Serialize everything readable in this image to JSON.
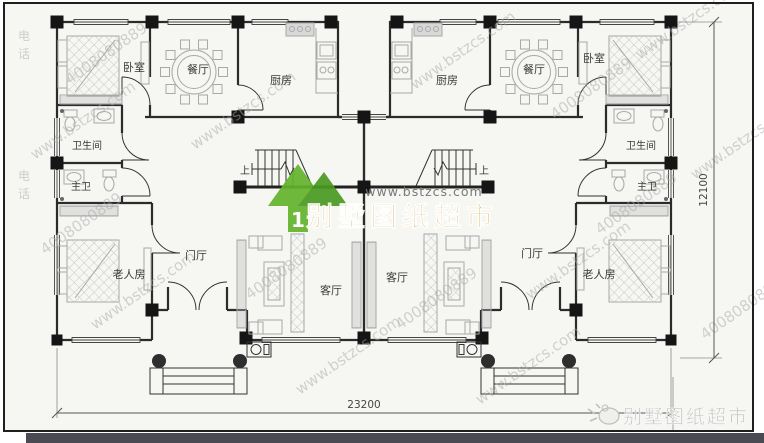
{
  "plan": {
    "rooms": {
      "bedroom": "卧室",
      "dining": "餐厅",
      "kitchen": "厨房",
      "bathroom": "卫生间",
      "master_bath": "主卫",
      "elder_room": "老人房",
      "foyer": "门厅",
      "living": "客厅"
    },
    "stairs_up": "上",
    "dimensions": {
      "width": "23200",
      "height": "12100"
    }
  },
  "watermark": {
    "url": "www.bstzcs.com",
    "phone": "4008080889",
    "cn_char_1": "电",
    "cn_char_2": "话"
  },
  "logo_center": {
    "url": "www.bstzcs.com",
    "title": "别墅图纸超市",
    "house_glyph": "1",
    "house_green_light": "#63b32c",
    "house_green_dark": "#4a9a22",
    "title_color": "#dd9a30"
  },
  "logo_corner": {
    "title": "别墅图纸超市"
  }
}
